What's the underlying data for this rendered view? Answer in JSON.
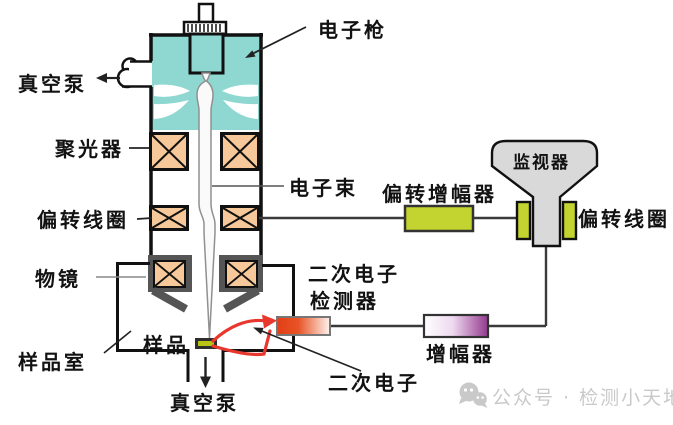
{
  "diagram": {
    "title_hint": "扫描电子显微镜结构示意图",
    "labels": {
      "electron_gun": "电子枪",
      "vacuum_pump_top": "真空泵",
      "condenser": "聚光器",
      "electron_beam": "电子束",
      "deflection_coil_left": "偏转线圈",
      "objective_lens": "物镜",
      "sample": "样品",
      "sample_chamber": "样品室",
      "vacuum_pump_bottom": "真空泵",
      "se_detector_line1": "二次电子",
      "se_detector_line2": "检测器",
      "secondary_electron": "二次电子",
      "deflection_amplifier": "偏转增幅器",
      "monitor": "监视器",
      "deflection_coil_right": "偏转线圈",
      "amplifier": "增幅器"
    },
    "colors": {
      "column_teal": "#8FD8D2",
      "lens_orange": "#F7C99A",
      "signal_green": "#C3D32F",
      "monitor_gray": "#D9D9D9",
      "amplifier_purple": "#93398F",
      "detector_red": "#E23F17",
      "se_path_red": "#E8382E",
      "pole_gray": "#555555",
      "outline_black": "#111111"
    },
    "watermark": {
      "icon": "wechat-icon",
      "text": "公众号 · 检测小天地"
    }
  }
}
